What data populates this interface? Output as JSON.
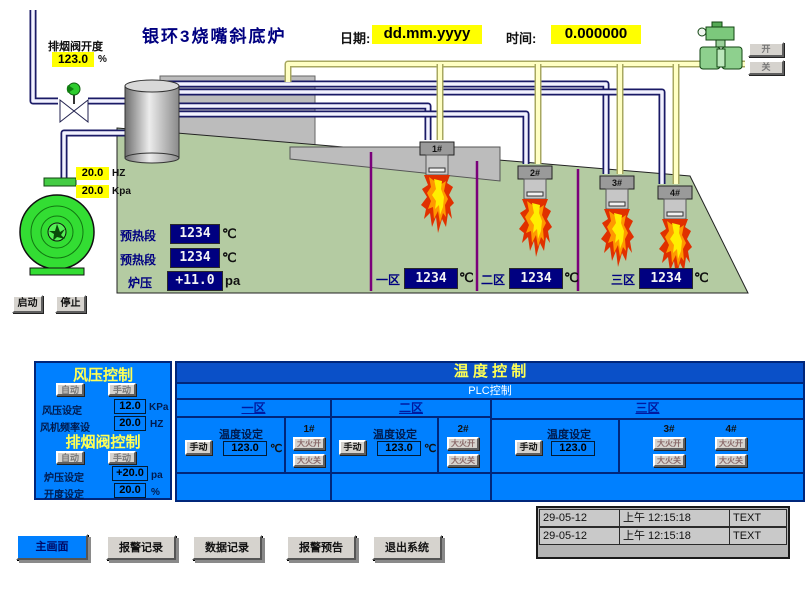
{
  "header": {
    "title": "银环3烧嘴斜底炉",
    "date_label": "日期:",
    "date_value": "dd.mm.yyyy",
    "time_label": "时间:",
    "time_value": "0.000000"
  },
  "colors": {
    "panel_blue": "#0080ff",
    "display_navy": "#000080",
    "highlight_yellow": "#ffff00",
    "furnace_green": "#b4cba2",
    "zone_divider_purple": "#7a007a"
  },
  "exhaust_valve": {
    "label": "排烟阀开度",
    "value": "123.0",
    "unit": "%"
  },
  "gas_valve": {
    "open_label": "开",
    "close_label": "关"
  },
  "fan": {
    "freq_value": "20.0",
    "freq_unit": "HZ",
    "pressure_value": "20.0",
    "pressure_unit": "Kpa",
    "start_label": "启动",
    "stop_label": "停止"
  },
  "furnace": {
    "preheat1": {
      "label": "预热段",
      "value": "1234",
      "unit": "℃"
    },
    "preheat2": {
      "label": "预热段",
      "value": "1234",
      "unit": "℃"
    },
    "pressure": {
      "label": "炉压",
      "value": "+11.0",
      "unit": "pa"
    },
    "zones": [
      {
        "label": "一区",
        "value": "1234",
        "unit": "℃"
      },
      {
        "label": "二区",
        "value": "1234",
        "unit": "℃"
      },
      {
        "label": "三区",
        "value": "1234",
        "unit": "℃"
      }
    ],
    "burners": [
      {
        "label": "1#"
      },
      {
        "label": "2#"
      },
      {
        "label": "3#"
      },
      {
        "label": "4#"
      }
    ]
  },
  "wind_panel": {
    "title": "风压控制",
    "auto_label": "自动",
    "manual_label": "手动",
    "pressure_set": {
      "label": "风压设定",
      "value": "12.0",
      "unit": "KPa"
    },
    "freq_set": {
      "label": "风机频率设",
      "value": "20.0",
      "unit": "HZ"
    },
    "exhaust_title": "排烟阀控制",
    "exhaust_auto_label": "自动",
    "exhaust_manual_label": "手动",
    "furnace_pressure_set": {
      "label": "炉压设定",
      "value": "+20.0",
      "unit": "pa"
    },
    "opening_set": {
      "label": "开度设定",
      "value": "20.0",
      "unit": "%"
    }
  },
  "temp_panel": {
    "title": "温  度  控  制",
    "subtitle": "PLC控制",
    "zone_headers": [
      "一区",
      "二区",
      "三区"
    ],
    "zones": [
      {
        "manual": "手动",
        "set_label": "温度设定",
        "set_value": "123.0",
        "set_unit": "℃"
      },
      {
        "manual": "手动",
        "set_label": "温度设定",
        "set_value": "123.0",
        "set_unit": "℃"
      },
      {
        "manual": "手动",
        "set_label": "温度设定",
        "set_value": "123.0",
        "set_unit": ""
      }
    ],
    "burner_controls": [
      {
        "id": "1#",
        "on": "大火开",
        "off": "大火关"
      },
      {
        "id": "2#",
        "on": "大火开",
        "off": "大火关"
      },
      {
        "id": "3#",
        "on": "大火开",
        "off": "大火关"
      },
      {
        "id": "4#",
        "on": "大火开",
        "off": "大火关"
      }
    ]
  },
  "nav": {
    "buttons": [
      {
        "label": "主画面"
      },
      {
        "label": "报警记录"
      },
      {
        "label": "数据记录"
      },
      {
        "label": "报警预告"
      },
      {
        "label": "退出系统"
      }
    ]
  },
  "alarms": {
    "rows": [
      {
        "date": "29-05-12",
        "time": "上午 12:15:18",
        "text": "TEXT"
      },
      {
        "date": "29-05-12",
        "time": "上午 12:15:18",
        "text": "TEXT"
      }
    ]
  }
}
